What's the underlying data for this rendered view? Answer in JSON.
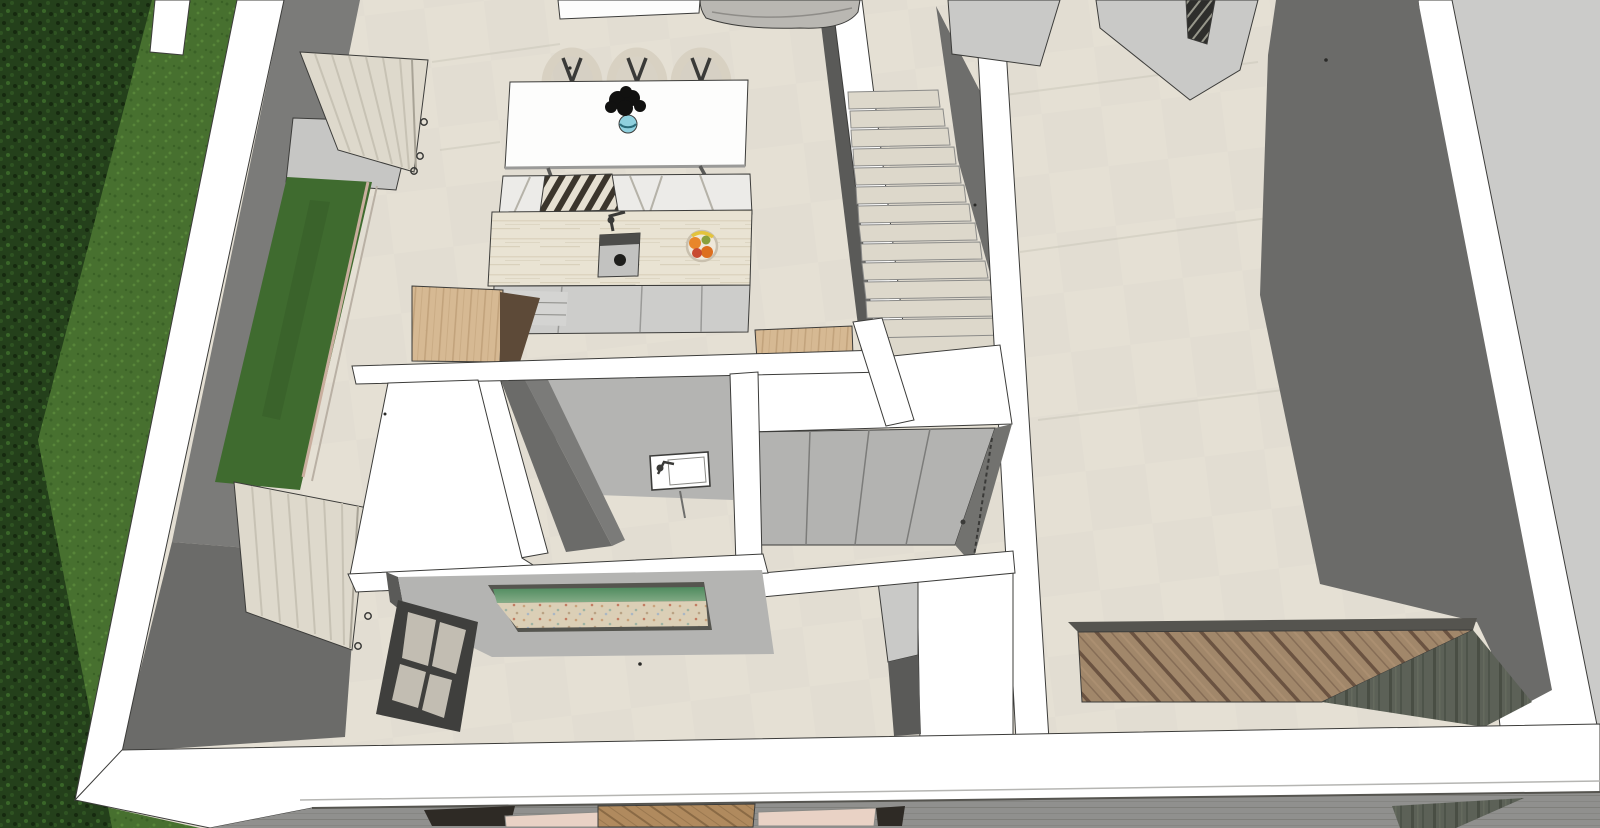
{
  "scene": {
    "type": "3d-architectural-model-render",
    "view": "isometric dollhouse top-down view of a house interior",
    "objects": [
      "garden-hedge",
      "lawn",
      "perimeter-wall",
      "sliding-glass-door",
      "curtains",
      "dining-table",
      "wishbone-chairs",
      "plant-in-vase",
      "bench-cushions",
      "striped-pillow",
      "kitchen-island",
      "island-sink",
      "fruit-bowl",
      "cabinet-fronts",
      "wood-counters",
      "staircase",
      "stair-landing",
      "hallway-floor",
      "low-partition-walls",
      "wardrobe-panels",
      "bathroom",
      "wall-hung-sink",
      "beach-wall-art",
      "window-grid",
      "wood-deck-platform",
      "slate-floor",
      "bed-with-headboard",
      "bed-pillows"
    ]
  },
  "colors": {
    "hedge_base": "#24401b",
    "hedge_dot1": "#16290f",
    "hedge_dot2": "#2f5322",
    "hedge_dot3": "#3a6629",
    "grass_base": "#47702f",
    "grass_dot1": "#3a6126",
    "grass_dot2": "#578539",
    "wall_white": "#ffffff",
    "wall_gray": "#7b7b79",
    "wall_gray_dark": "#6b6b69",
    "wall_gray_deep": "#5a5a58",
    "exterior_concrete": "#cbcbc9",
    "floor_base": "#e2ddd2",
    "floor_light": "#e8e3d8",
    "panel_light": "#c9c9c7",
    "stair_tread": "#ddd8cb",
    "stair_face": "#c6c1b4",
    "stair_shadow": "#6e6e6c",
    "sofa_gray": "#b9b7b2",
    "table_white": "#fdfdfc",
    "chair_beige": "#d8d1c2",
    "chair_seat": "#cfc8ba",
    "chair_dark": "#3a3a38",
    "cushion_white": "#ecebe8",
    "pillow_stripe_dark": "#3b352c",
    "pillow_stripe_light": "#e6e0d2",
    "island_trav_base": "#e9e3d3",
    "island_trav_streak": "#d9d1bc",
    "cabinet_gray": "#cdcdcb",
    "cabinet_line": "#9a9a98",
    "sink_body": "#c2c2c0",
    "sink_rim": "#4c4c4a",
    "sink_dot": "#1e1e1c",
    "counter_wood": "#d6b993",
    "counter_wood_grain": "#c2a37c",
    "counter_shadow": "#5d4a38",
    "fruit_orange": "#e8862a",
    "fruit_orange2": "#dd6f1f",
    "fruit_red": "#c84a30",
    "fruit_green": "#8aa03c",
    "fruit_banana": "#e3c33c",
    "bowl": "#efe8da",
    "bowl_rim": "#c9c0ae",
    "plant_black": "#111110",
    "vase_teal": "#8fd0de",
    "vase_rim": "#2a6a78",
    "curtain_light": "#ded9cc",
    "curtain_mid": "#c7c2b4",
    "curtain_dark": "#a8a396",
    "glass_green": "#3f6b2f",
    "glass_green_dark": "#355c27",
    "frame_pink": "#c9ae9e",
    "frame_pink2": "#b9b0a4",
    "door_slab": "#c6c6c4",
    "bath_wall": "#b4b4b2",
    "bath_sink_white": "#ffffff",
    "wardrobe_panel": "#b3b3b1",
    "wardrobe_panel_edge": "#7c7c7a",
    "wardrobe_side": "#72726f",
    "art_green_top": "#4e8a5e",
    "art_green_light": "#86ad88",
    "art_sand": "#dbcfb6",
    "art_frame": "#55554f",
    "window_frame": "#3f3f3d",
    "window_pane": "#c2bdb2",
    "deck_wood": "#a1876a",
    "deck_wood_dark": "#6b5341",
    "deck_wood_light": "#b59878",
    "deck_edge": "#55544f",
    "slate_dark": "#5c6157",
    "slate_streak": "#494e44",
    "slate_light": "#6a7062",
    "band_gray": "#90908e",
    "band_gray_line": "#7f7f7b",
    "bed_wood": "#b08a5e",
    "bed_wood_grain": "#8a6a45",
    "bed_pillow": "#e9d2c5",
    "bed_dark": "#2e2a25",
    "hatch_dark": "#2e2e2c",
    "hatch_light": "#97978b"
  }
}
